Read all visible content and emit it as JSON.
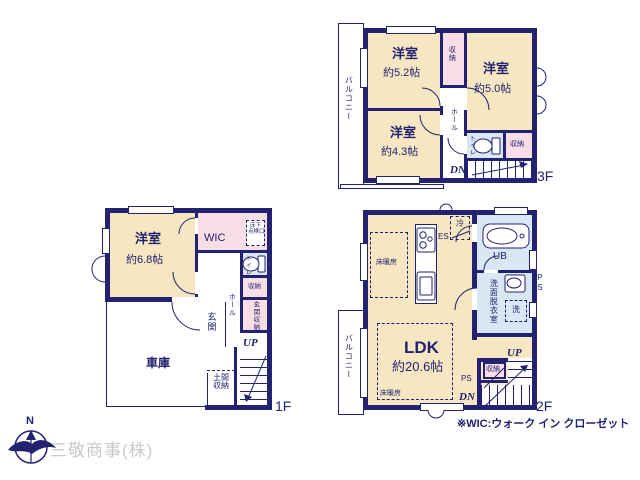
{
  "colors": {
    "wall": "#232270",
    "room_cream": "#f6e7c2",
    "closet_pink": "#f7dde6",
    "wet_blue": "#d8e7f3",
    "company_gray": "#c9c9c9"
  },
  "floor1": {
    "label": "1F",
    "room": {
      "name": "洋室",
      "size": "約6.8帖"
    },
    "wic": "WIC",
    "hatch": [
      "床下",
      "点検口"
    ],
    "toilet": "トイレ",
    "closet": "収納",
    "entry_closet": "玄関収納",
    "hall": "ホール",
    "entrance": "玄関",
    "up": "UP",
    "garage": "車庫",
    "doma": [
      "土間",
      "収納"
    ]
  },
  "floor2": {
    "label": "2F",
    "balcony": "バルコニー",
    "ldk": {
      "name": "LDK",
      "size": "約20.6帖"
    },
    "floor_heating_top": "床暖房",
    "floor_heating_bottom": "床暖房",
    "fridge": "冷",
    "es": "ES",
    "unit_bath": "UB",
    "washroom": "洗面脱衣室",
    "washer": "洗",
    "ps_right": "PS",
    "ps_left": "PS",
    "closet": "収納",
    "up": "UP",
    "dn": "DN"
  },
  "floor3": {
    "label": "3F",
    "balcony": "バルコニー",
    "room_a": {
      "name": "洋室",
      "size": "約5.2帖"
    },
    "room_b": {
      "name": "洋室",
      "size": "約5.0帖"
    },
    "room_c": {
      "name": "洋室",
      "size": "約4.3帖"
    },
    "closet_top": "収納",
    "closet_side": "収納",
    "hall": "ホール",
    "toilet": "トイレ",
    "dn": "DN"
  },
  "footer": {
    "note": "※WIC:ウォーク イン クローゼット",
    "company": "三敬商事(株)",
    "compass_north": "N"
  }
}
